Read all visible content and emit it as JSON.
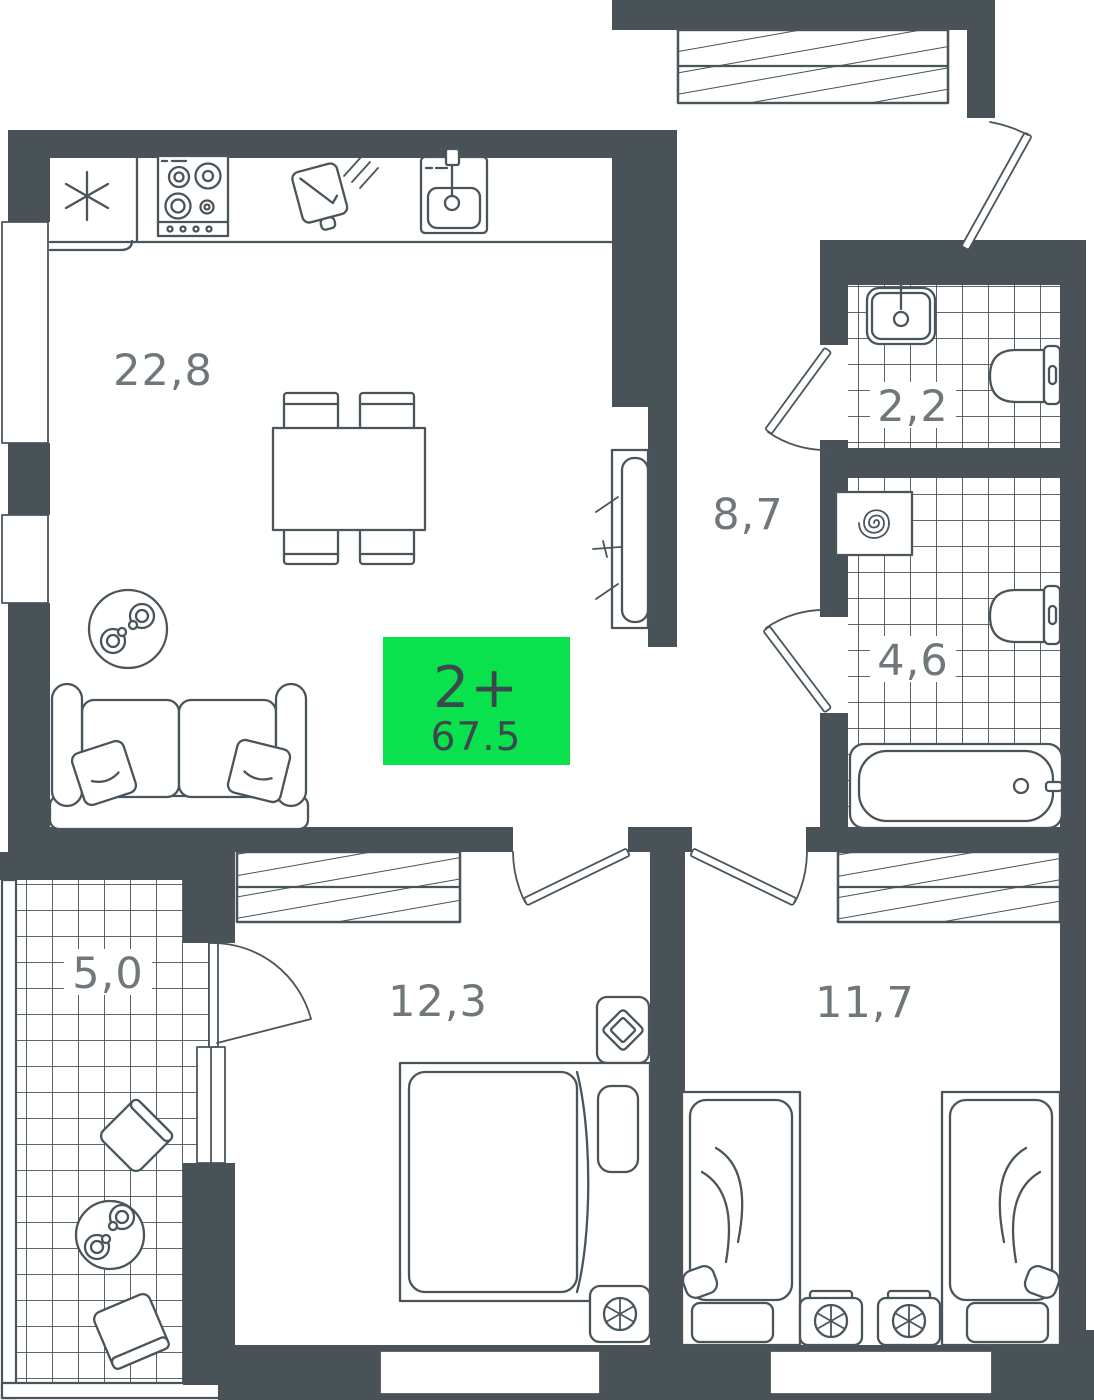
{
  "plan": {
    "badge": {
      "rooms": "2+",
      "area": "67.5"
    },
    "rooms": [
      {
        "id": "kitchen-living",
        "area": "22,8"
      },
      {
        "id": "hallway",
        "area": "8,7"
      },
      {
        "id": "wc",
        "area": "2,2"
      },
      {
        "id": "bathroom",
        "area": "4,6"
      },
      {
        "id": "balcony",
        "area": "5,0"
      },
      {
        "id": "bedroom-1",
        "area": "12,3"
      },
      {
        "id": "bedroom-2",
        "area": "11,7"
      }
    ],
    "icons": {
      "fridge": "snowflake-asterisk",
      "stove": "four-burner-hob",
      "cutting_board": "cutting-board-with-knife",
      "sink": "kitchen-sink",
      "tv": "wall-tv",
      "sofa": "two-seat-sofa",
      "coffee_table": "round-table-with-cups",
      "dining": "table-with-four-chairs",
      "wardrobe": "hatched-closet",
      "washbasin": "wash-basin",
      "toilet": "toilet-top-view",
      "washing_machine": "spiral-drum-machine",
      "bathtub": "bathtub-top-view",
      "double_bed": "double-bed",
      "single_bed": "single-bed",
      "nightstand": "nightstand",
      "plant": "plant-top-view",
      "balcony_set": "two-chairs-round-table"
    },
    "colors": {
      "wall": "#485257",
      "line": "#4A555B",
      "label": "#6F777B",
      "badge_bg": "#0AE24D",
      "badge_text": "#3C484D",
      "bg": "#FFFFFF"
    }
  }
}
